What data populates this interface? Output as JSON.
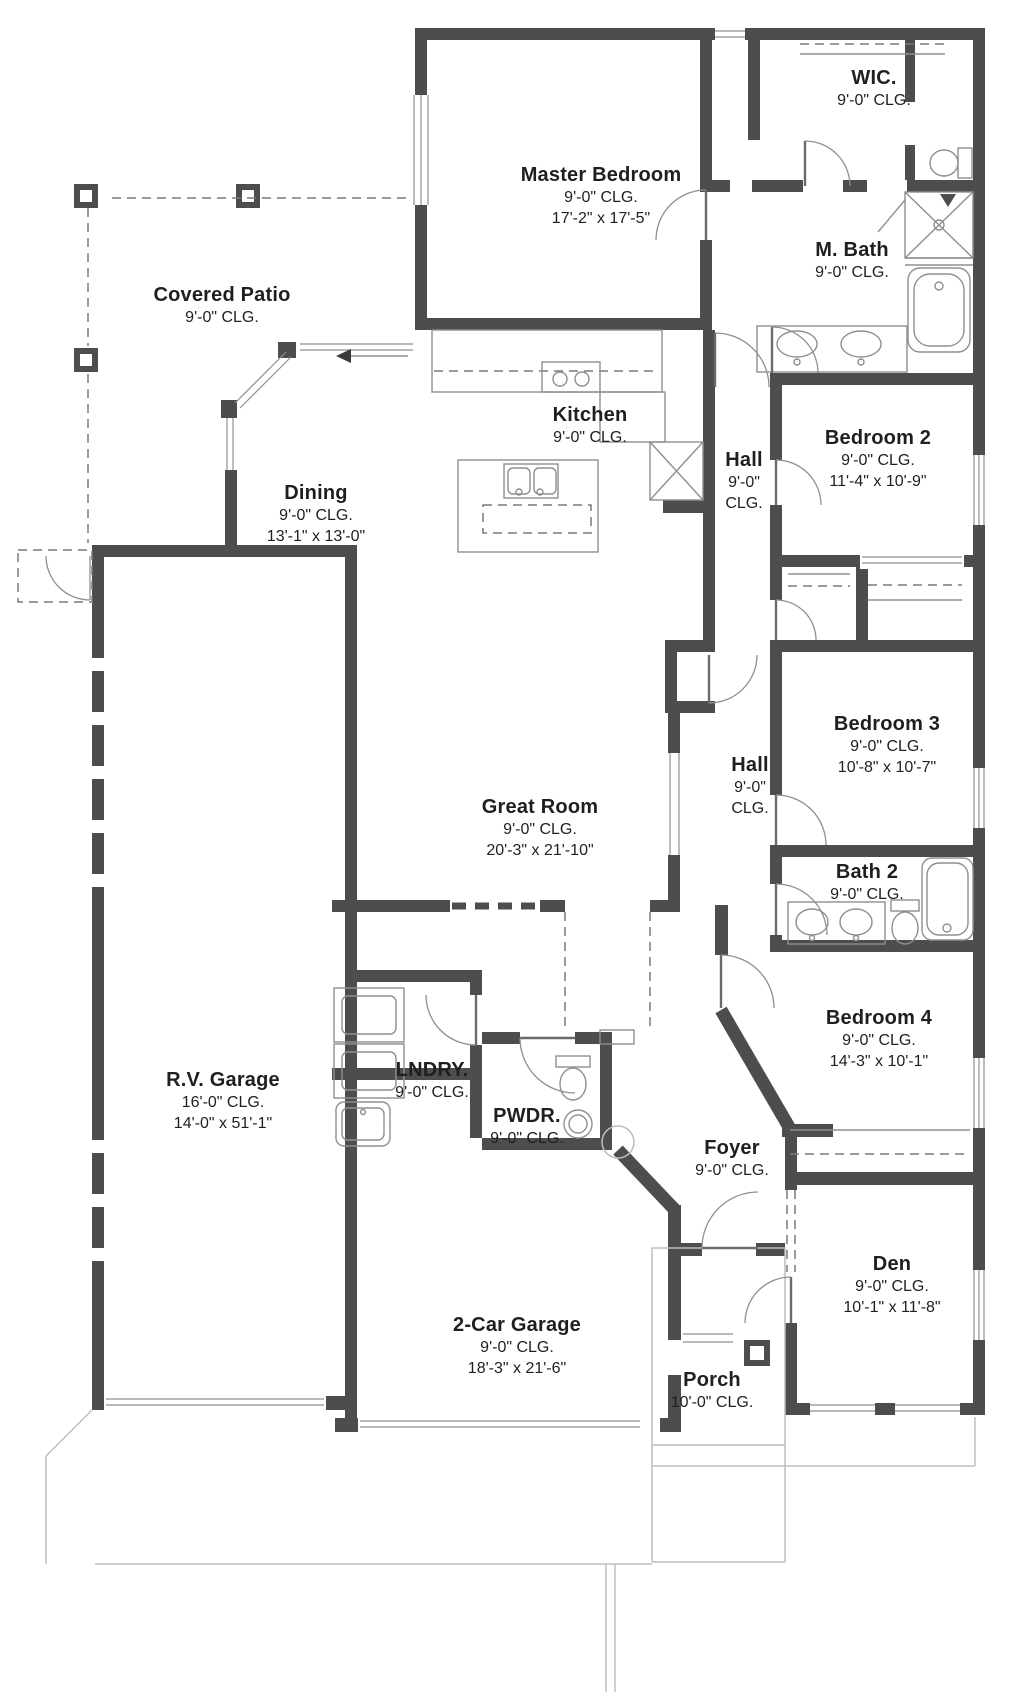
{
  "colors": {
    "wall": "#4d4d4d",
    "fixture_line": "#8f8f8f",
    "site_line": "#bdbdbd",
    "dashed_line": "#7a7a7a",
    "text": "#1f1f1f",
    "background": "#ffffff"
  },
  "fixtures": [
    "kitchen-sink-icon",
    "cooktop-icon",
    "refrigerator-icon",
    "kitchen-island-icon",
    "double-vanity-icon",
    "shower-icon",
    "bathtub-icon",
    "toilet-icon",
    "washer-dryer-icon",
    "laundry-sink-icon",
    "pedestal-sink-icon",
    "closet-shelf-icon",
    "patio-post-icon",
    "door-swing-icon",
    "sliding-door-arrow-icon"
  ],
  "rooms": [
    {
      "id": "covered-patio",
      "name": "Covered Patio",
      "ceiling": "9'-0\" CLG.",
      "dims": ""
    },
    {
      "id": "master-bedroom",
      "name": "Master Bedroom",
      "ceiling": "9'-0\" CLG.",
      "dims": "17'-2\" x 17'-5\""
    },
    {
      "id": "wic",
      "name": "WIC.",
      "ceiling": "9'-0\" CLG.",
      "dims": ""
    },
    {
      "id": "m-bath",
      "name": "M. Bath",
      "ceiling": "9'-0\" CLG.",
      "dims": ""
    },
    {
      "id": "bedroom-2",
      "name": "Bedroom 2",
      "ceiling": "9'-0\" CLG.",
      "dims": "11'-4\" x 10'-9\""
    },
    {
      "id": "hall-1",
      "name": "Hall",
      "ceiling": "9'-0\"\nCLG.",
      "dims": ""
    },
    {
      "id": "kitchen",
      "name": "Kitchen",
      "ceiling": "9'-0\" CLG.",
      "dims": ""
    },
    {
      "id": "dining",
      "name": "Dining",
      "ceiling": "9'-0\" CLG.",
      "dims": "13'-1\" x 13'-0\""
    },
    {
      "id": "great-room",
      "name": "Great Room",
      "ceiling": "9'-0\" CLG.",
      "dims": "20'-3\" x 21'-10\""
    },
    {
      "id": "hall-2",
      "name": "Hall",
      "ceiling": "9'-0\"\nCLG.",
      "dims": ""
    },
    {
      "id": "bedroom-3",
      "name": "Bedroom 3",
      "ceiling": "9'-0\" CLG.",
      "dims": "10'-8\" x 10'-7\""
    },
    {
      "id": "bath-2",
      "name": "Bath 2",
      "ceiling": "9'-0\" CLG.",
      "dims": ""
    },
    {
      "id": "bedroom-4",
      "name": "Bedroom 4",
      "ceiling": "9'-0\" CLG.",
      "dims": "14'-3\" x 10'-1\""
    },
    {
      "id": "rv-garage",
      "name": "R.V. Garage",
      "ceiling": "16'-0\" CLG.",
      "dims": "14'-0\" x 51'-1\""
    },
    {
      "id": "lndry",
      "name": "LNDRY.",
      "ceiling": "9'-0\" CLG.",
      "dims": ""
    },
    {
      "id": "pwdr",
      "name": "PWDR.",
      "ceiling": "9'-0\" CLG.",
      "dims": ""
    },
    {
      "id": "foyer",
      "name": "Foyer",
      "ceiling": "9'-0\" CLG.",
      "dims": ""
    },
    {
      "id": "den",
      "name": "Den",
      "ceiling": "9'-0\" CLG.",
      "dims": "10'-1\" x 11'-8\""
    },
    {
      "id": "two-car-garage",
      "name": "2-Car Garage",
      "ceiling": "9'-0\" CLG.",
      "dims": "18'-3\" x 21'-6\""
    },
    {
      "id": "porch",
      "name": "Porch",
      "ceiling": "10'-0\" CLG.",
      "dims": ""
    }
  ]
}
